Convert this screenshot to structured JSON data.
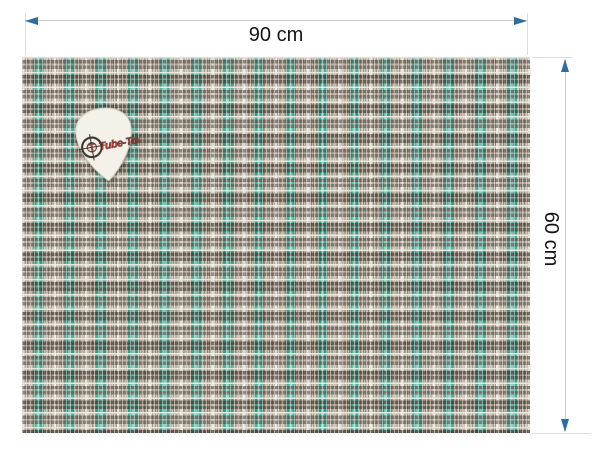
{
  "photo": {
    "width_label": "90 cm",
    "height_label": "60 cm"
  },
  "pick": {
    "brand": "Tube-Town",
    "scope_letter": "T"
  },
  "colors": {
    "arrow": "#2e6da0",
    "dim_line": "#c3cdd3",
    "ext_line": "#dadee1",
    "label_text": "#141414",
    "fabric_tan": "#ccc4b2",
    "fabric_teal": "#3aa596",
    "fabric_teal_light": "#7bd0c3",
    "fabric_dark": "#352a20",
    "fabric_white": "#efece2",
    "pick_body": "#f4f1e8",
    "logo_red": "#c0392b",
    "logo_dark": "#3a3330"
  }
}
